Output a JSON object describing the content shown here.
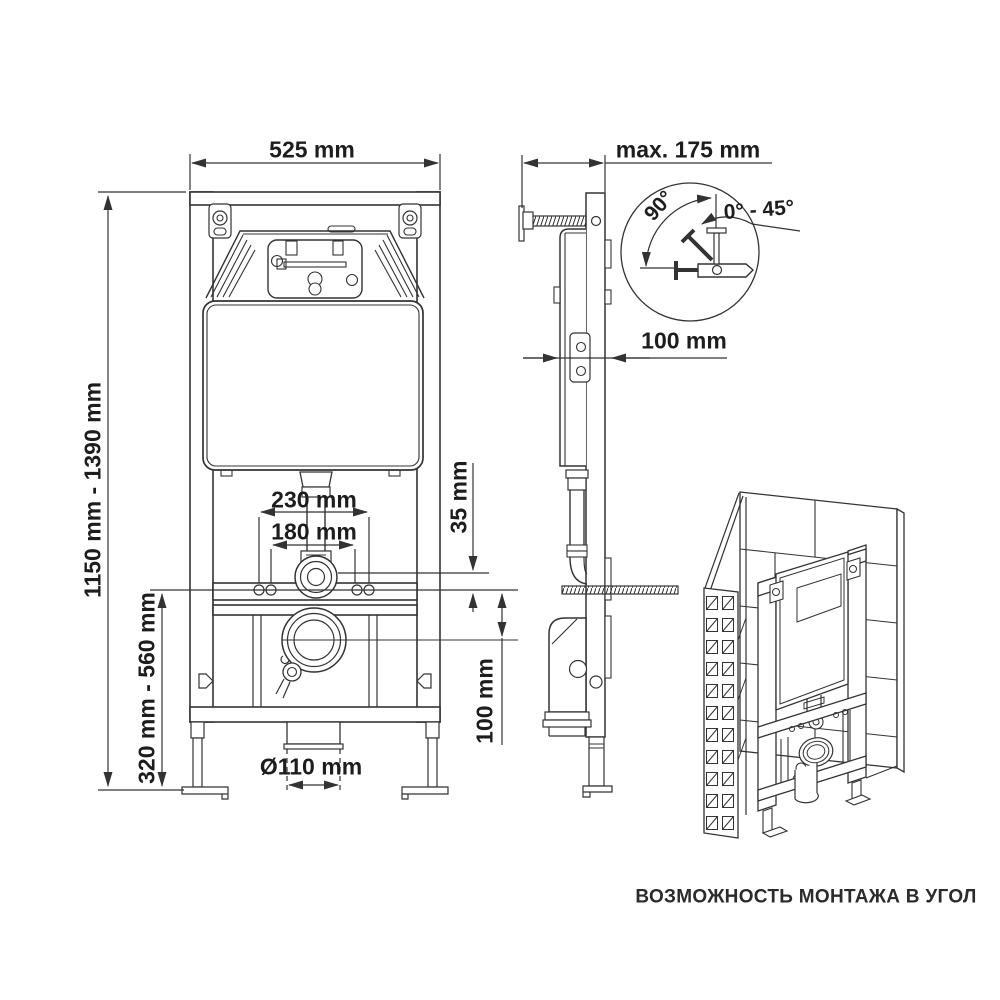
{
  "page": {
    "background": "#ffffff",
    "line_color": "#333333",
    "text_color": "#1d1d1d"
  },
  "front_view": {
    "width": "525 mm",
    "height_range": "1150 mm - 1390 mm",
    "lower_height_range": "320 mm - 560 mm",
    "flush_bend_spacing": "230 mm",
    "fixing_bolt_spacing": "180 mm",
    "flush_bend_offset": "35 mm",
    "outlet_center_offset": "100 mm",
    "outlet_diameter": "Ø110 mm"
  },
  "side_view": {
    "wall_distance_max": "max. 175 mm",
    "frame_depth": "100 mm"
  },
  "rotation_detail": {
    "angle_full": "90°",
    "angle_range": "0° - 45°"
  },
  "corner_view": {
    "caption": "ВОЗМОЖНОСТЬ МОНТАЖА В УГОЛ"
  }
}
